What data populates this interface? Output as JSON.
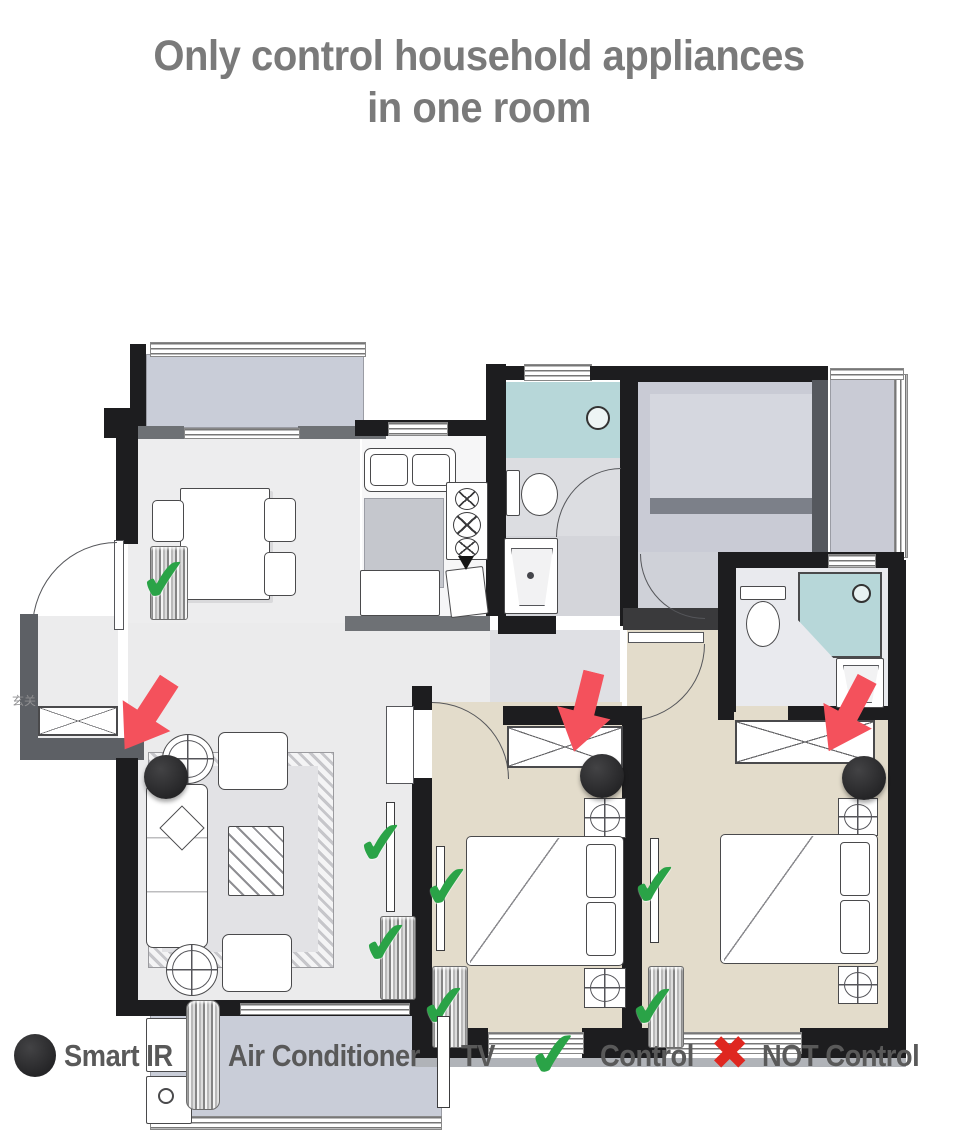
{
  "title": {
    "line1": "Only control household appliances",
    "line2": "in one room"
  },
  "floor_plan": {
    "entry_label": "玄关",
    "rooms": [
      "balcony-top-left",
      "dining-room",
      "kitchen",
      "bathroom-middle",
      "study",
      "balcony-right",
      "bathroom-right",
      "hallway",
      "living-room",
      "bedroom-1",
      "bedroom-2",
      "balcony-bottom-left"
    ],
    "smart_ir_count": 3,
    "arrow_count": 3,
    "control_check_count": 7
  },
  "glyphs": {
    "check": "✔",
    "cross": "✖"
  },
  "legend": {
    "items": [
      {
        "icon": "smart-ir-dot-icon",
        "label": "Smart IR"
      },
      {
        "icon": "air-conditioner-icon",
        "label": "Air Conditioner"
      },
      {
        "icon": "tv-icon",
        "label": "TV"
      },
      {
        "icon": "check-icon",
        "label": "Control"
      },
      {
        "icon": "cross-icon",
        "label": "NOT Control"
      }
    ]
  },
  "colors": {
    "title_gray": "#7a7a7a",
    "check_green": "#2aa347",
    "cross_red": "#df2720",
    "arrow_red": "#f4515c",
    "smart_ir_dot": "#2c2c2e",
    "bedroom_floor": "#e3dccb",
    "living_floor": "#ebebec",
    "balcony_floor": "#c9cdd8",
    "bath_teal": "#b7d7d9",
    "wall_black": "#1d1d1f"
  }
}
